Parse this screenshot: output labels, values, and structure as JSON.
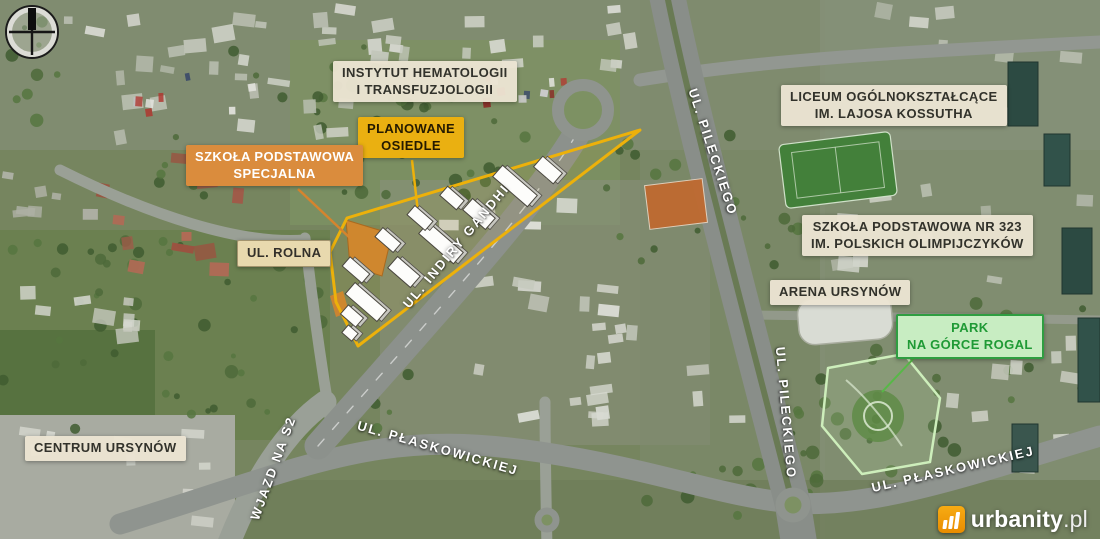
{
  "page": {
    "type": "aerial-map-infographic",
    "location_context": "Ursynów, Warszawa"
  },
  "palette": {
    "accent_yellow": "#eab011",
    "accent_orange": "#da8c3d",
    "label_cream": "#ebe4d2",
    "park_green_bg": "#c8edc2",
    "park_green_text": "#1f9a35",
    "development_outline": "#edb10a",
    "brand_orange": "#f09a0a"
  },
  "icons": {
    "compass": "compass-north-icon",
    "watermark_logo": "urbanity-building-bars-icon"
  },
  "labels": {
    "instytut": {
      "line1": "INSTYTUT HEMATOLOGII",
      "line2": "I TRANSFUZJOLOGII"
    },
    "planowane_osiedle": {
      "line1": "PLANOWANE",
      "line2": "OSIEDLE"
    },
    "szkola_specjalna": {
      "line1": "SZKOŁA PODSTAWOWA",
      "line2": "SPECJALNA"
    },
    "ul_rolna": {
      "text": "UL. ROLNA"
    },
    "liceum": {
      "line1": "LICEUM OGÓLNOKSZTAŁCĄCE",
      "line2": "IM. LAJOSA KOSSUTHA"
    },
    "szkola_323": {
      "line1": "SZKOŁA PODSTAWOWA NR 323",
      "line2": "IM. POLSKICH OLIMPIJCZYKÓW"
    },
    "arena": {
      "text": "ARENA URSYNÓW"
    },
    "park_rogal": {
      "line1": "PARK",
      "line2": "NA GÓRCE ROGAL"
    },
    "centrum": {
      "text": "CENTRUM URSYNÓW"
    }
  },
  "streets": {
    "pileckiego_north": "UL. PILECKIEGO",
    "pileckiego_south": "UL. PILECKIEGO",
    "indiry_gandhi": "UL. INDIRY GANDHI",
    "plaskowickiej_west": "UL. PŁASKOWICKIEJ",
    "plaskowickiej_east": "UL. PŁASKOWICKIEJ",
    "wjazd_s2": "WJAZD NA S2"
  },
  "watermark": {
    "brand": "urbanity",
    "tld": ".pl"
  }
}
